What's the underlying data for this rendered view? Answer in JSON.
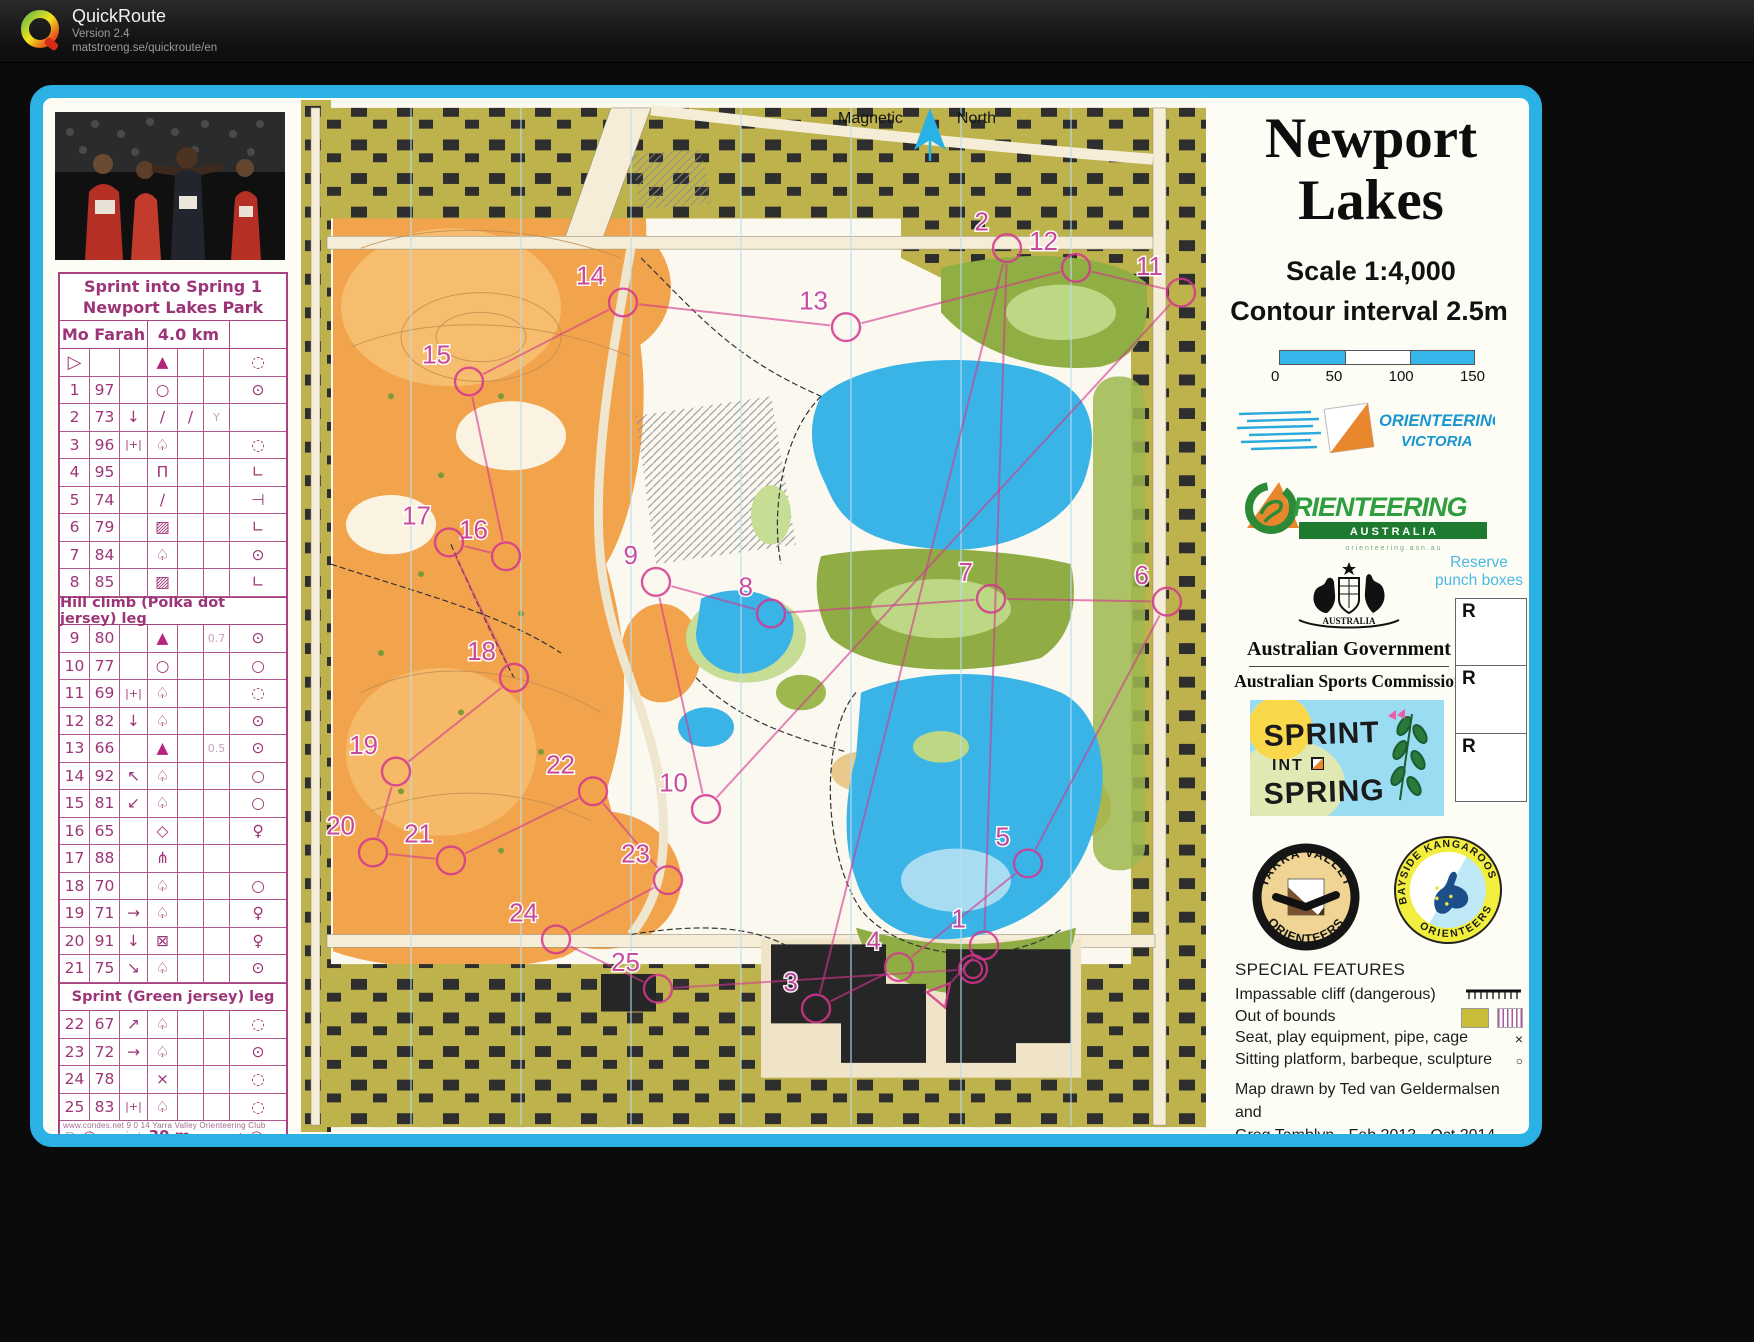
{
  "app": {
    "name": "QuickRoute",
    "version": "Version 2.4",
    "url": "matstroeng.se/quickroute/en"
  },
  "north": {
    "left": "Magnetic",
    "right": "North"
  },
  "titles": {
    "line1": "Newport",
    "line2": "Lakes",
    "scale": "Scale 1:4,000",
    "contour": "Contour interval 2.5m"
  },
  "scalebar": {
    "ticks": [
      "0",
      "50",
      "100",
      "150"
    ]
  },
  "logos": {
    "ov": {
      "line1": "ORIENTEERING",
      "line2": "VICTORIA"
    },
    "oa": {
      "word": "RIENTEERING",
      "banner": "A U S T R A L I A",
      "sub": "o r i e n t e e r i n g . a s n . a u"
    },
    "gov": {
      "country": "AUSTRALIA",
      "line1": "Australian Government",
      "line2": "Australian Sports Commission"
    },
    "sprint": {
      "line1": "SPRINT",
      "line2": "INT",
      "line3": "SPRING"
    },
    "yv": {
      "top": "YARRA VALLEY",
      "bottom": "ORIENTEERS"
    },
    "bk": {
      "top": "BAYSIDE KANGAROOS",
      "bottom": "ORIENTEERS"
    }
  },
  "punch": {
    "label1": "Reserve",
    "label2": "punch boxes",
    "boxes": [
      "R",
      "R",
      "R"
    ]
  },
  "special": {
    "heading": "SPECIAL FEATURES",
    "items": [
      {
        "label": "Impassable cliff (dangerous)"
      },
      {
        "label": "Out of bounds"
      },
      {
        "label": "Seat, play equipment, pipe, cage"
      },
      {
        "label": "Sitting platform, barbeque, sculpture"
      }
    ]
  },
  "credits": {
    "line1": "Map drawn by Ted van Geldermalsen and",
    "line2": "Greg Tamblyn - Feb 2013 - Oct 2014"
  },
  "footer": {
    "condes": "www.condes.net 9 0 14 Yarra Valley Orienteering Club",
    "pretex": "Pretex print"
  },
  "control_card": {
    "event1": "Sprint into Spring 1",
    "event2": "Newport Lakes Park",
    "runner": "Mo Farah",
    "distance": "4.0 km",
    "rows": [
      {
        "a": "▷",
        "b": "",
        "c": "",
        "d": "▲",
        "e": "",
        "f": "",
        "g": "◌"
      },
      {
        "a": "1",
        "b": "97",
        "c": "",
        "d": "○",
        "e": "",
        "f": "",
        "g": "⊙"
      },
      {
        "a": "2",
        "b": "73",
        "c": "↓",
        "d": "∕",
        "e": "∕",
        "f": "Y",
        "g": ""
      },
      {
        "a": "3",
        "b": "96",
        "c": "|+|",
        "d": "♤",
        "e": "",
        "f": "",
        "g": "◌"
      },
      {
        "a": "4",
        "b": "95",
        "c": "",
        "d": "Π",
        "e": "",
        "f": "",
        "g": "∟"
      },
      {
        "a": "5",
        "b": "74",
        "c": "",
        "d": "∕",
        "e": "",
        "f": "",
        "g": "⊣"
      },
      {
        "a": "6",
        "b": "79",
        "c": "",
        "d": "▨",
        "e": "",
        "f": "",
        "g": "∟"
      },
      {
        "a": "7",
        "b": "84",
        "c": "",
        "d": "♤",
        "e": "",
        "f": "",
        "g": "⊙"
      },
      {
        "a": "8",
        "b": "85",
        "c": "",
        "d": "▨",
        "e": "",
        "f": "",
        "g": "∟"
      },
      {
        "section": "Hill climb (Polka dot jersey) leg"
      },
      {
        "a": "9",
        "b": "80",
        "c": "",
        "d": "▲",
        "e": "",
        "f": "0.7",
        "g": "⊙"
      },
      {
        "a": "10",
        "b": "77",
        "c": "",
        "d": "○",
        "e": "",
        "f": "",
        "g": "○"
      },
      {
        "a": "11",
        "b": "69",
        "c": "|+|",
        "d": "♤",
        "e": "",
        "f": "",
        "g": "◌"
      },
      {
        "a": "12",
        "b": "82",
        "c": "↓",
        "d": "♤",
        "e": "",
        "f": "",
        "g": "⊙"
      },
      {
        "a": "13",
        "b": "66",
        "c": "",
        "d": "▲",
        "e": "",
        "f": "0.5",
        "g": "⊙"
      },
      {
        "a": "14",
        "b": "92",
        "c": "↖",
        "d": "♤",
        "e": "",
        "f": "",
        "g": "○"
      },
      {
        "a": "15",
        "b": "81",
        "c": "↙",
        "d": "♤",
        "e": "",
        "f": "",
        "g": "○"
      },
      {
        "a": "16",
        "b": "65",
        "c": "",
        "d": "◇",
        "e": "",
        "f": "",
        "g": "♀"
      },
      {
        "a": "17",
        "b": "88",
        "c": "",
        "d": "⋔",
        "e": "",
        "f": "",
        "g": ""
      },
      {
        "a": "18",
        "b": "70",
        "c": "",
        "d": "♤",
        "e": "",
        "f": "",
        "g": "○"
      },
      {
        "a": "19",
        "b": "71",
        "c": "→",
        "d": "♤",
        "e": "",
        "f": "",
        "g": "♀"
      },
      {
        "a": "20",
        "b": "91",
        "c": "↓",
        "d": "⊠",
        "e": "",
        "f": "",
        "g": "♀"
      },
      {
        "a": "21",
        "b": "75",
        "c": "↘",
        "d": "♤",
        "e": "",
        "f": "",
        "g": "⊙"
      },
      {
        "section": "Sprint (Green jersey) leg"
      },
      {
        "a": "22",
        "b": "67",
        "c": "↗",
        "d": "♤",
        "e": "",
        "f": "",
        "g": "◌"
      },
      {
        "a": "23",
        "b": "72",
        "c": "→",
        "d": "♤",
        "e": "",
        "f": "",
        "g": "⊙"
      },
      {
        "a": "24",
        "b": "78",
        "c": "",
        "d": "×",
        "e": "",
        "f": "",
        "g": "◌"
      },
      {
        "a": "25",
        "b": "83",
        "c": "|+|",
        "d": "♤",
        "e": "",
        "f": "",
        "g": "◌"
      }
    ],
    "finish": {
      "start_sym": "○",
      "dash1": "- - - -",
      "label": "30 m",
      "dash2": "- - -",
      "arrow": "→",
      "finish_sym": "◎"
    }
  },
  "map": {
    "accent": "#d4368f",
    "controls": [
      {
        "n": 1,
        "x": 683,
        "y": 856
      },
      {
        "n": 2,
        "x": 706,
        "y": 150
      },
      {
        "n": 3,
        "x": 515,
        "y": 920
      },
      {
        "n": 4,
        "x": 598,
        "y": 878
      },
      {
        "n": 5,
        "x": 727,
        "y": 773
      },
      {
        "n": 6,
        "x": 866,
        "y": 508
      },
      {
        "n": 7,
        "x": 690,
        "y": 505
      },
      {
        "n": 8,
        "x": 470,
        "y": 520
      },
      {
        "n": 9,
        "x": 355,
        "y": 488
      },
      {
        "n": 10,
        "x": 405,
        "y": 718
      },
      {
        "n": 11,
        "x": 880,
        "y": 195
      },
      {
        "n": 12,
        "x": 775,
        "y": 170
      },
      {
        "n": 13,
        "x": 545,
        "y": 230
      },
      {
        "n": 14,
        "x": 322,
        "y": 205
      },
      {
        "n": 15,
        "x": 168,
        "y": 285
      },
      {
        "n": 16,
        "x": 205,
        "y": 462
      },
      {
        "n": 17,
        "x": 148,
        "y": 448
      },
      {
        "n": 18,
        "x": 213,
        "y": 585
      },
      {
        "n": 19,
        "x": 95,
        "y": 680
      },
      {
        "n": 20,
        "x": 72,
        "y": 762
      },
      {
        "n": 21,
        "x": 150,
        "y": 770
      },
      {
        "n": 22,
        "x": 292,
        "y": 700
      },
      {
        "n": 23,
        "x": 367,
        "y": 790
      },
      {
        "n": 24,
        "x": 255,
        "y": 850
      },
      {
        "n": 25,
        "x": 357,
        "y": 900
      }
    ],
    "start": {
      "x": 640,
      "y": 905
    },
    "finish": {
      "x": 672,
      "y": 880
    }
  }
}
